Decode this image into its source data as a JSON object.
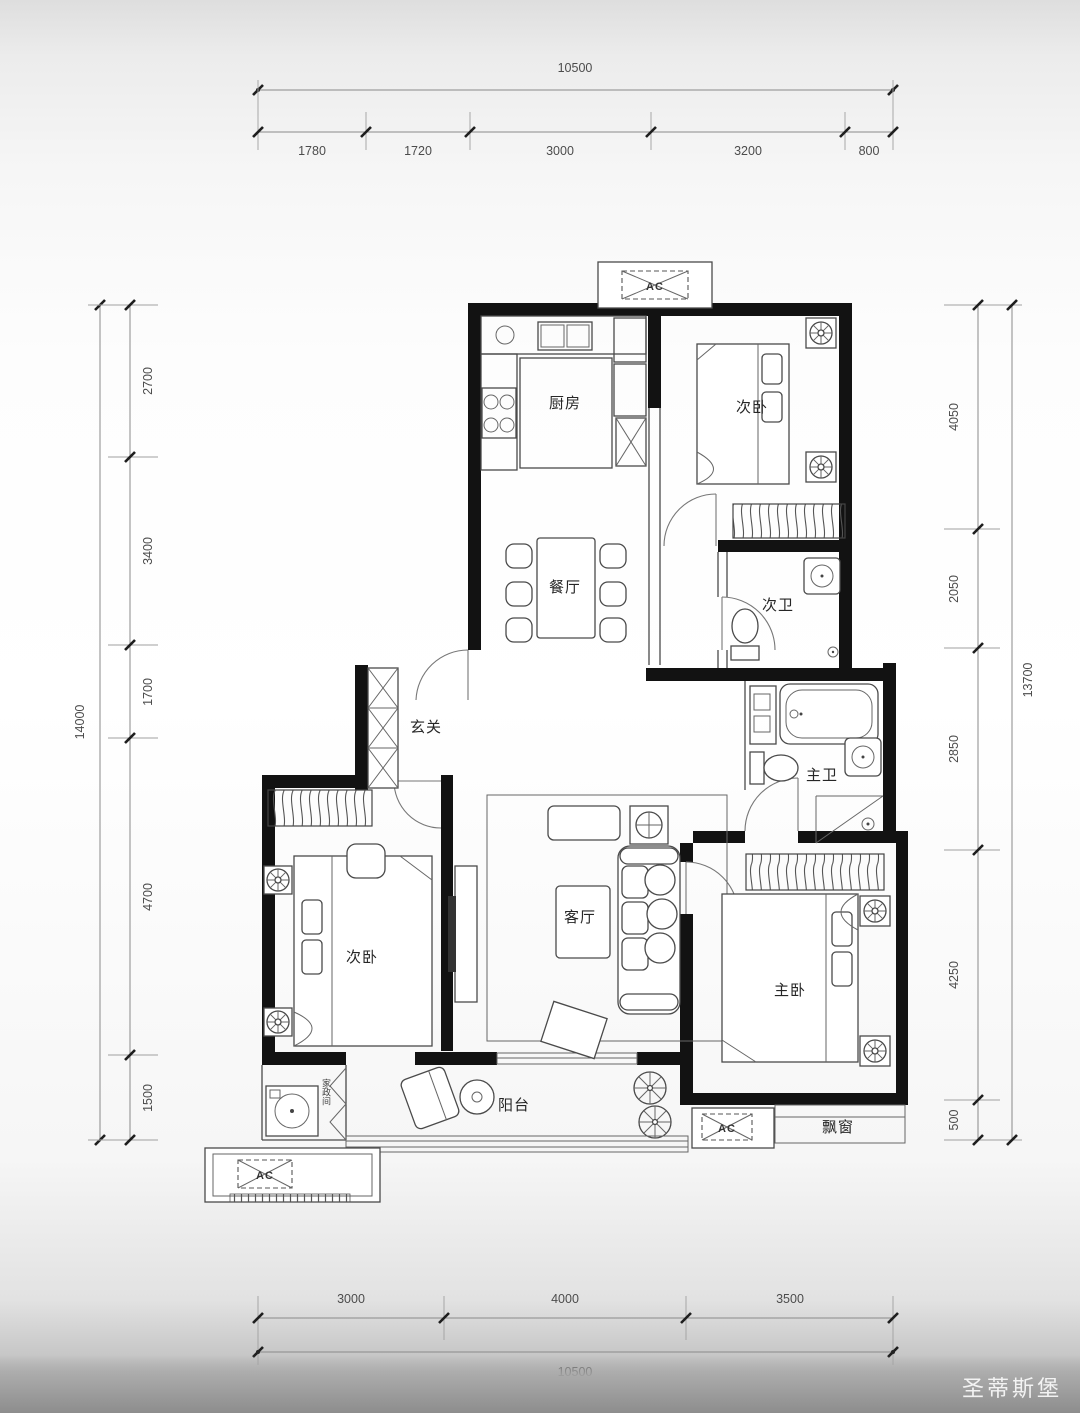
{
  "dimensions": {
    "top": {
      "total": "10500",
      "segments": [
        "1780",
        "1720",
        "3000",
        "3200",
        "800"
      ]
    },
    "bottom": {
      "total": "10500",
      "segments": [
        "3000",
        "4000",
        "3500"
      ]
    },
    "left": {
      "total": "14000",
      "segments": [
        "2700",
        "3400",
        "1700",
        "4700",
        "1500"
      ]
    },
    "right": {
      "total": "13700",
      "segments": [
        "4050",
        "2050",
        "2850",
        "4250",
        "500"
      ]
    }
  },
  "rooms": {
    "kitchen": "厨房",
    "bedroom_top": "次卧",
    "dining": "餐厅",
    "bath_top": "次卫",
    "entry": "玄关",
    "bath_master": "主卫",
    "bedroom_left": "次卧",
    "living": "客厅",
    "bedroom_master": "主卧",
    "balcony": "阳台",
    "bay_window": "飘窗",
    "utility": "家政间"
  },
  "ac_label": "AC",
  "watermark": "圣蒂斯堡",
  "colors": {
    "wall": "#121212",
    "paper": "#ffffff",
    "dim_text": "#4c4c4c",
    "watermark_text": "#fafafa"
  }
}
